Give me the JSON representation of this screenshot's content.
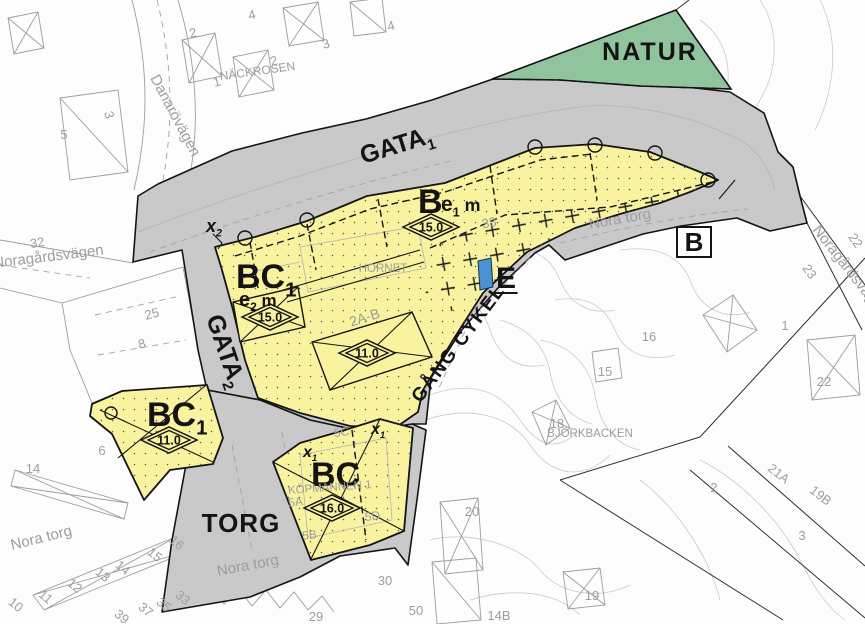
{
  "map": {
    "colors": {
      "road_gray": "#c9c9c9",
      "nature_green": "#8fc49d",
      "building_yellow": "#f9f3a0",
      "tech_blue": "#4a93d2",
      "boundary_black": "#141414",
      "basemap_text": "#9d9d9d",
      "contour_gray": "#c9c9c9"
    },
    "labels": [
      {
        "name": "zone-label-natur",
        "t": "NATUR",
        "x": 650,
        "y": 60,
        "s": 25,
        "w": 600,
        "ls": 2
      },
      {
        "name": "zone-label-gata1",
        "t": "GATA",
        "sub": "1",
        "x": 363,
        "y": 164,
        "s": 25,
        "w": 600,
        "rot": -17,
        "a": "start"
      },
      {
        "name": "zone-label-gata2",
        "t": "GATA",
        "sub": "2",
        "x": 206,
        "y": 318,
        "s": 25,
        "w": 600,
        "rot": 71,
        "a": "start"
      },
      {
        "name": "zone-label-b",
        "t": "B",
        "x": 418,
        "y": 213,
        "s": 34,
        "w": 700,
        "a": "start"
      },
      {
        "name": "zone-label-e1m",
        "t": "e",
        "sub": "1",
        "suf": " m",
        "x": 441,
        "y": 211,
        "s": 21,
        "w": 600,
        "a": "start"
      },
      {
        "name": "zone-label-bc1",
        "t": "BC",
        "sub": "1",
        "x": 236,
        "y": 288,
        "s": 34,
        "w": 700,
        "a": "start"
      },
      {
        "name": "zone-label-e2m",
        "t": "e",
        "sub": "2",
        "suf": " m",
        "x": 239,
        "y": 306,
        "s": 20,
        "w": 600,
        "a": "start"
      },
      {
        "name": "zone-label-e",
        "t": "E",
        "x": 496,
        "y": 288,
        "s": 30,
        "w": 700,
        "a": "start",
        "ul": 1
      },
      {
        "name": "zone-label-b-boxed",
        "t": "B",
        "x": 694,
        "y": 251,
        "s": 26,
        "w": 700,
        "box": 1
      },
      {
        "name": "zone-label-bc1-south",
        "t": "BC",
        "sub": "1",
        "x": 147,
        "y": 426,
        "s": 34,
        "w": 700,
        "a": "start"
      },
      {
        "name": "zone-label-bc-south",
        "t": "BC",
        "x": 311,
        "y": 486,
        "s": 34,
        "w": 700,
        "a": "start"
      },
      {
        "name": "zone-label-torg",
        "t": "TORG",
        "x": 241,
        "y": 532,
        "s": 26,
        "w": 600,
        "ls": 1
      },
      {
        "name": "zone-label-gang-cykel",
        "t": "GÅNG  CYKEL",
        "x": 463,
        "y": 347,
        "s": 19,
        "w": 600,
        "rot": -53,
        "ls": 1.5
      },
      {
        "name": "admin-label-x2",
        "t": "x",
        "sub": "2",
        "x": 206,
        "y": 232,
        "s": 18,
        "w": 700,
        "i": 1,
        "a": "start"
      },
      {
        "name": "admin-label-x1-a",
        "t": "x",
        "sub": "1",
        "x": 303,
        "y": 457,
        "s": 16,
        "w": 700,
        "i": 1,
        "a": "start"
      },
      {
        "name": "admin-label-x1-b",
        "t": "x",
        "sub": "1",
        "x": 371,
        "y": 434,
        "s": 16,
        "w": 700,
        "i": 1,
        "a": "start"
      },
      {
        "name": "street-danarovagen",
        "t": "Danarövägen",
        "x": 150,
        "y": 78,
        "s": 15,
        "c": "g",
        "rot": 62,
        "a": "start"
      },
      {
        "name": "quarter-nackrosen",
        "t": "NÄCKROSEN",
        "x": 258,
        "y": 75,
        "s": 12,
        "c": "g",
        "rot": -8
      },
      {
        "name": "street-noragardsvagen-west",
        "t": "Noragårdsvägen",
        "x": -6,
        "y": 268,
        "s": 15,
        "c": "g",
        "rot": -7,
        "a": "start"
      },
      {
        "name": "street-noragardsvagen-east",
        "t": "Noragårdsvägen",
        "x": 812,
        "y": 230,
        "s": 15,
        "c": "g",
        "rot": 52,
        "a": "start"
      },
      {
        "name": "street-nora-torg-road",
        "t": "Nora torg",
        "x": 590,
        "y": 229,
        "s": 15,
        "c": "g",
        "rot": -10,
        "a": "start"
      },
      {
        "name": "street-nora-torg-sw",
        "t": "Nora torg",
        "x": 12,
        "y": 550,
        "s": 15,
        "c": "g",
        "rot": -14,
        "a": "start"
      },
      {
        "name": "street-nora-torg-s",
        "t": "Nora torg",
        "x": 218,
        "y": 576,
        "s": 15,
        "c": "g",
        "rot": -11,
        "a": "start"
      },
      {
        "name": "quarter-hornet",
        "t": "HORNET",
        "x": 383,
        "y": 272,
        "s": 11.5,
        "c": "g"
      },
      {
        "name": "address-2a-b",
        "t": "2A-B",
        "x": 366,
        "y": 322,
        "s": 14,
        "c": "g",
        "rot": -18
      },
      {
        "name": "quarter-kopmannen",
        "t": "KÖPMANNEN 1",
        "x": 330,
        "y": 491,
        "s": 11.5,
        "c": "g",
        "rot": -4
      },
      {
        "name": "quarter-bjorkbacken",
        "t": "BJÖRKBACKEN",
        "x": 590,
        "y": 437,
        "s": 11.5,
        "c": "g"
      },
      {
        "name": "basemap-number",
        "t": "32",
        "x": 38,
        "y": 247,
        "c": "g",
        "rot": -10
      },
      {
        "name": "basemap-number",
        "t": "25",
        "x": 153,
        "y": 318,
        "c": "g",
        "rot": -15
      },
      {
        "name": "basemap-number",
        "t": "8",
        "x": 143,
        "y": 348,
        "c": "g",
        "rot": -15
      },
      {
        "name": "basemap-number",
        "t": "2",
        "x": 194,
        "y": 37,
        "c": "g",
        "rot": -15
      },
      {
        "name": "basemap-number",
        "t": "4",
        "x": 253,
        "y": 19,
        "c": "g",
        "rot": -15
      },
      {
        "name": "basemap-number",
        "t": "1",
        "x": 218,
        "y": 86,
        "c": "g",
        "rot": -15
      },
      {
        "name": "basemap-number",
        "t": "2",
        "x": 275,
        "y": 65,
        "c": "g",
        "rot": -15
      },
      {
        "name": "basemap-number",
        "t": "3",
        "x": 327,
        "y": 48,
        "c": "g",
        "rot": -15
      },
      {
        "name": "basemap-number",
        "t": "4",
        "x": 392,
        "y": 30,
        "c": "g",
        "rot": -15
      },
      {
        "name": "basemap-number",
        "t": "3",
        "x": 105,
        "y": 116,
        "c": "g",
        "rot": 75
      },
      {
        "name": "basemap-number",
        "t": "5",
        "x": 64,
        "y": 139,
        "c": "g"
      },
      {
        "name": "basemap-number",
        "t": "6",
        "x": 102,
        "y": 455,
        "c": "g"
      },
      {
        "name": "basemap-number",
        "t": "14",
        "x": 33,
        "y": 473,
        "c": "g"
      },
      {
        "name": "basemap-number",
        "t": "16",
        "x": 174,
        "y": 546,
        "c": "g",
        "rot": 40
      },
      {
        "name": "basemap-number",
        "t": "15",
        "x": 152,
        "y": 558,
        "c": "g",
        "rot": 40
      },
      {
        "name": "basemap-number",
        "t": "14",
        "x": 120,
        "y": 571,
        "c": "g",
        "rot": 40
      },
      {
        "name": "basemap-number",
        "t": "13",
        "x": 100,
        "y": 578,
        "c": "g",
        "rot": 40
      },
      {
        "name": "basemap-number",
        "t": "12",
        "x": 72,
        "y": 589,
        "c": "g",
        "rot": 40
      },
      {
        "name": "basemap-number",
        "t": "11",
        "x": 43,
        "y": 600,
        "c": "g",
        "rot": 40
      },
      {
        "name": "basemap-number",
        "t": "10",
        "x": 13,
        "y": 608,
        "c": "g",
        "rot": 40
      },
      {
        "name": "basemap-number",
        "t": "39",
        "x": 119,
        "y": 620,
        "c": "g",
        "rot": 40
      },
      {
        "name": "basemap-number",
        "t": "37",
        "x": 143,
        "y": 613,
        "c": "g",
        "rot": 40
      },
      {
        "name": "basemap-number",
        "t": "35",
        "x": 161,
        "y": 608,
        "c": "g",
        "rot": 40
      },
      {
        "name": "basemap-number",
        "t": "33",
        "x": 180,
        "y": 601,
        "c": "g",
        "rot": 40
      },
      {
        "name": "basemap-number",
        "t": "5A",
        "x": 296,
        "y": 506,
        "s": 12,
        "c": "g",
        "rot": -8
      },
      {
        "name": "basemap-number",
        "t": "5B",
        "x": 310,
        "y": 539,
        "s": 12,
        "c": "g",
        "rot": -8
      },
      {
        "name": "basemap-number",
        "t": "5C",
        "x": 342,
        "y": 436,
        "s": 12,
        "c": "g",
        "rot": -8
      },
      {
        "name": "basemap-number",
        "t": "5D",
        "x": 373,
        "y": 520,
        "s": 12,
        "c": "g",
        "rot": -8
      },
      {
        "name": "basemap-number",
        "t": "50",
        "x": 416,
        "y": 615,
        "c": "g"
      },
      {
        "name": "basemap-number",
        "t": "30",
        "x": 385,
        "y": 585,
        "c": "g"
      },
      {
        "name": "basemap-number",
        "t": "29",
        "x": 316,
        "y": 621,
        "c": "g"
      },
      {
        "name": "basemap-number",
        "t": "16",
        "x": 649,
        "y": 341,
        "c": "g"
      },
      {
        "name": "basemap-number",
        "t": "15",
        "x": 605,
        "y": 376,
        "c": "g"
      },
      {
        "name": "basemap-number",
        "t": "18",
        "x": 557,
        "y": 428,
        "c": "g"
      },
      {
        "name": "basemap-number",
        "t": "20",
        "x": 472,
        "y": 516,
        "c": "g"
      },
      {
        "name": "basemap-number",
        "t": "19",
        "x": 592,
        "y": 600,
        "c": "g"
      },
      {
        "name": "basemap-number",
        "t": "14B",
        "x": 499,
        "y": 620,
        "c": "g"
      },
      {
        "name": "basemap-number",
        "t": "22",
        "x": 824,
        "y": 386,
        "c": "g"
      },
      {
        "name": "basemap-number",
        "t": "23",
        "x": 806,
        "y": 274,
        "c": "g",
        "rot": 55
      },
      {
        "name": "basemap-number",
        "t": "22",
        "x": 852,
        "y": 243,
        "c": "g",
        "rot": 55
      },
      {
        "name": "basemap-number",
        "t": "1",
        "x": 785,
        "y": 330,
        "c": "g"
      },
      {
        "name": "basemap-number",
        "t": "2",
        "x": 714,
        "y": 492,
        "c": "g"
      },
      {
        "name": "basemap-number",
        "t": "3",
        "x": 802,
        "y": 540,
        "c": "g"
      },
      {
        "name": "basemap-number",
        "t": "21A",
        "x": 776,
        "y": 477,
        "c": "g",
        "rot": 38
      },
      {
        "name": "basemap-number",
        "t": "19B",
        "x": 818,
        "y": 499,
        "c": "g",
        "rot": 38
      },
      {
        "name": "basemap-number",
        "t": "33",
        "x": 490,
        "y": 227,
        "c": "g",
        "rot": -12
      }
    ],
    "diamonds": [
      {
        "name": "height-limit",
        "value": "15.0",
        "x": 431,
        "y": 227
      },
      {
        "name": "height-limit",
        "value": "15.0",
        "x": 270,
        "y": 317
      },
      {
        "name": "height-limit",
        "value": "11.0",
        "x": 367,
        "y": 353
      },
      {
        "name": "height-limit",
        "value": "11.0",
        "x": 169,
        "y": 440
      },
      {
        "name": "height-limit",
        "value": "16.0",
        "x": 332,
        "y": 508
      }
    ]
  }
}
